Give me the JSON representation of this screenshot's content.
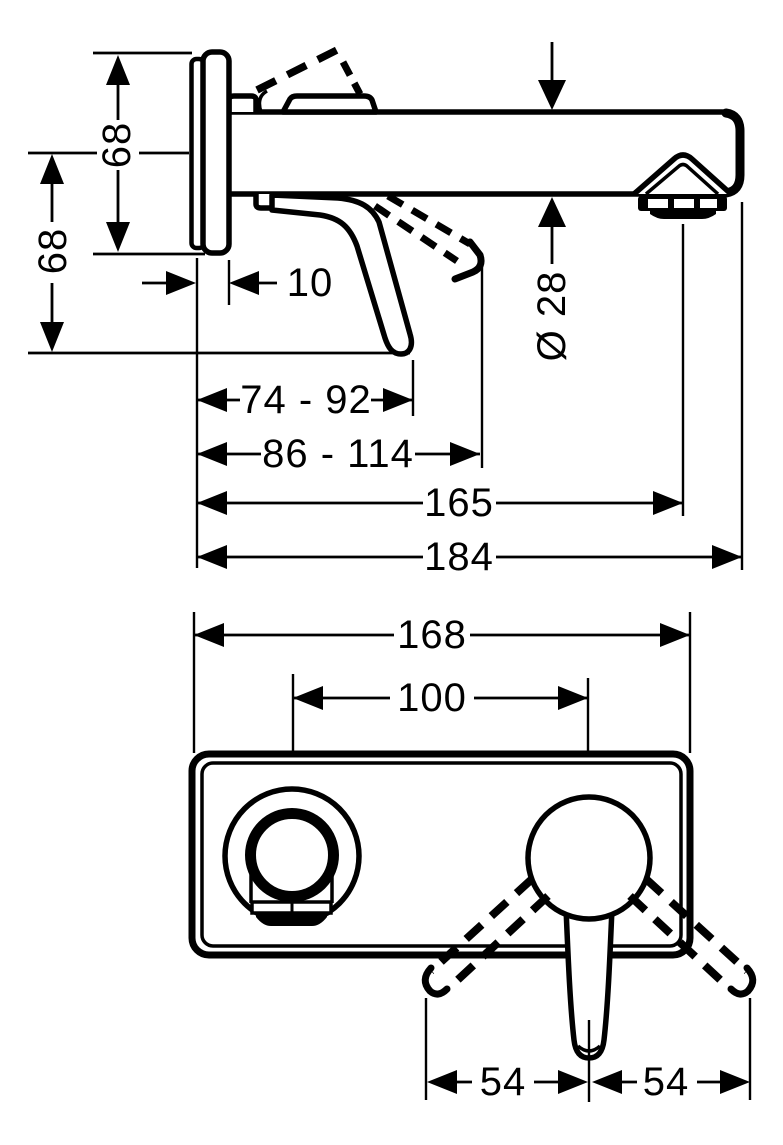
{
  "colors": {
    "line": "#000000",
    "background": "#ffffff"
  },
  "side_view": {
    "upper_height": "68",
    "lower_height": "68",
    "plate_depth": "10",
    "spout_reach_range": "74 - 92",
    "handle_reach_range": "86 - 114",
    "aerator_distance": "165",
    "total_projection": "184",
    "spout_diameter": "Ø 28"
  },
  "front_view": {
    "plate_width": "168",
    "hole_spacing": "100",
    "left_offset": "54",
    "right_offset": "54"
  }
}
